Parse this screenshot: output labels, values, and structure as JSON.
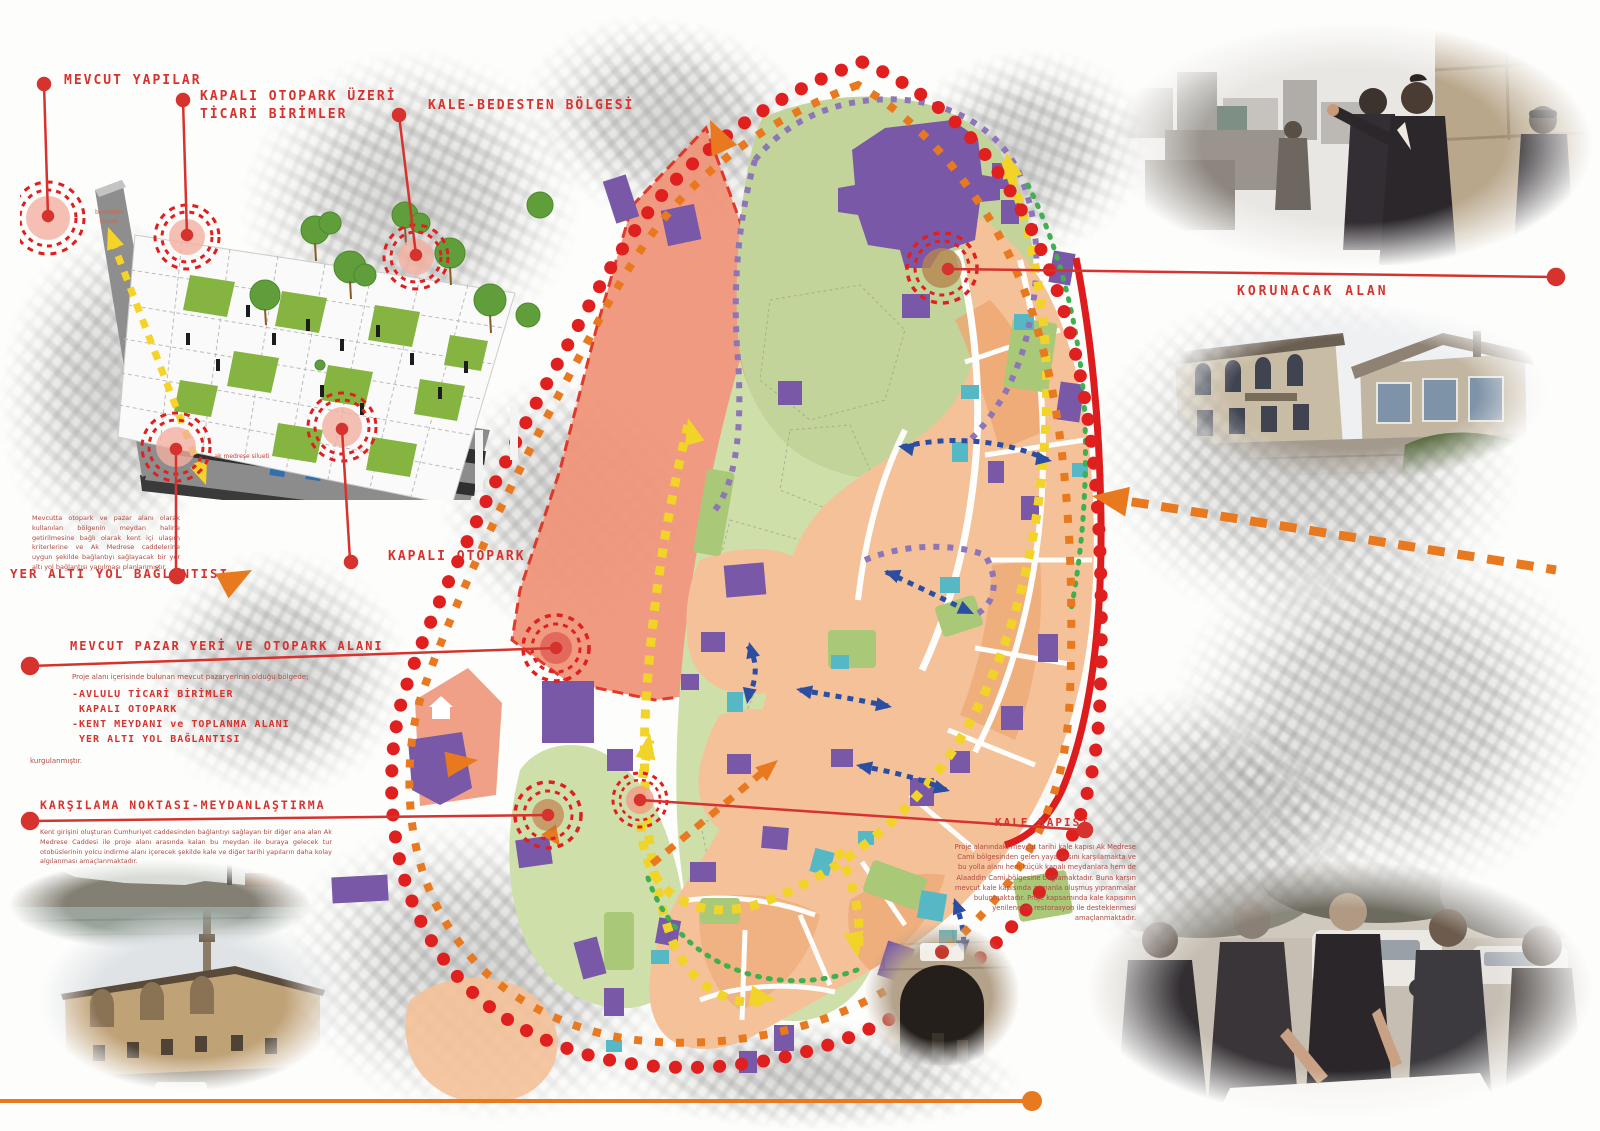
{
  "poster": {
    "callouts": {
      "mevcut_yapilar": "MEVCUT YAPILAR",
      "kapali_otopark_uzeri": "KAPALI OTOPARK ÜZERİ\nTİCARİ BİRİMLER",
      "kale_bedesten": "KALE-BEDESTEN BÖLGESİ",
      "korunacak_alan": "KORUNACAK ALAN",
      "kapali_otopark": "KAPALI OTOPARK"
    },
    "diagram_notes": {
      "top": "bedesten\nsilueti",
      "bottom": "ak medrese\nsilueti"
    },
    "sections": {
      "yer_alti": {
        "title": "YER ALTI YOL BAĞLANTISI",
        "body": "Mevcutta otopark ve pazar alanı olarak kullanılan bölgenin meydan haline getirilmesine bağlı olarak kent içi ulaşım kriterlerine ve Ak Medrese caddelerine uygun şekilde bağlantıyı sağlayacak bir yer altı yol bağlantısı yapılması planlanmıştır."
      },
      "pazar": {
        "title": "MEVCUT PAZAR YERİ VE OTOPARK ALANI",
        "intro": "Proje alanı içerisinde bulunan mevcut pazaryerinin olduğu bölgede;",
        "items": [
          "-AVLULU TİCARİ BİRİMLER",
          " KAPALI OTOPARK",
          "-KENT MEYDANI ve TOPLANMA ALANI",
          " YER ALTI YOL BAĞLANTISI"
        ],
        "outro": "kurgulanmıştır."
      },
      "karsilama": {
        "title": "KARŞILAMA NOKTASI-MEYDANLAŞTIRMA",
        "body": "Kent girişini oluşturan Cumhuriyet caddesinden bağlantıyı sağlayan bir diğer ana alan Ak Medrese Caddesi ile proje alanı arasında kalan bu meydan ile buraya gelecek tur otobüslerinin yolcu indirme alanı içerecek şekilde kale ve diğer tarihi yapıların daha kolay algılanması amaçlanmaktadır."
      },
      "kale_kapisi": {
        "title": "KALE KAPISI",
        "body": "Proje alanındaki mevcut tarihi kale kapısı Ak Medrese Cami bölgesinden gelen yaya aksını karşılamakta ve bu yolla alanı hem küçük kapalı meydanlara hem de Alaaddin Cami bölgesine bağlamaktadır. Buna karşın mevcut kale kapısında zamanla oluşmuş yıpranmalar bulunmaktadır. Proje kapsamında kale kapısının yenilenerek restorasyon ile desteklenmesi amaçlanmaktadır."
      }
    },
    "palette": {
      "accent_red": "#d6322e",
      "boundary_red": "#e01f1f",
      "orange": "#e8791f",
      "salmon_zone": "#f0967b",
      "green_light": "#cfdfaa",
      "park_green": "#c3d49a",
      "route_yellow": "#f2d327",
      "purple_building": "#7a58a8",
      "teal_building": "#57b8c5",
      "peach_fabric": "#f5c199",
      "arrow_blue": "#2b4ea2",
      "red_line": "#dd1d1d"
    }
  }
}
